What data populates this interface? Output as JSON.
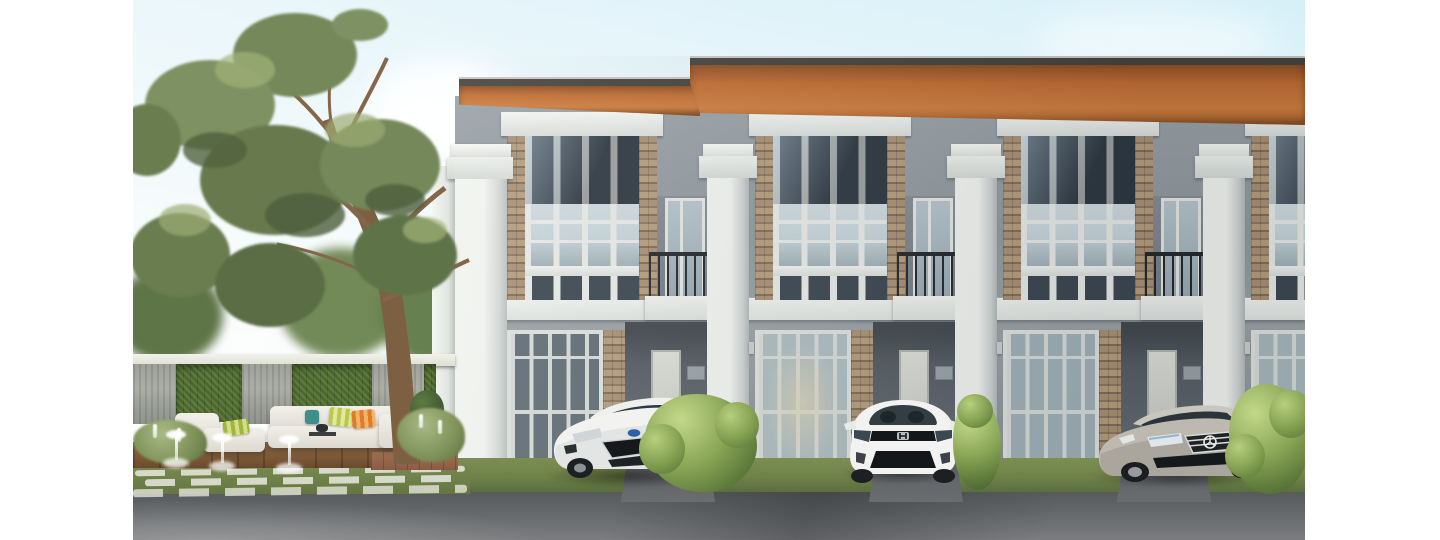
{
  "scene": {
    "description": "3D architectural rendering of a row of modern two-storey townhomes with orange timber roof eaves, parked cars in carports, and a landscaped garden courtyard with a large tree, vertical-garden boundary wall, outdoor sofa and lawn fountains",
    "palette": {
      "sky_top": "#a4cbdf",
      "sky_horizon": "#f1f4f1",
      "roof_soffit": "#bf6a2e",
      "roof_fascia": "#43403a",
      "wall_upper": "#8f979c",
      "wall_lower": "#888f94",
      "trim_white": "#e9ebe7",
      "glass_dark": "#3e4a55",
      "glass_light": "#c5d3d8",
      "stone": "#a18a6d",
      "carport_shadow": "#5c636a",
      "grass": "#6f8248",
      "hedge": "#4d6831",
      "deck_wood": "#7c5836",
      "road": "#636669",
      "car_white": "#f2f3f1",
      "car_silver": "#b6b2aa",
      "railing_black": "#23272b"
    }
  },
  "objects": {
    "tree": {
      "label": "large garden tree"
    },
    "garden_wall": {
      "label": "boundary wall with stone pillars and vertical garden panels",
      "pillar_count": 3,
      "hedge_panel_count": 2
    },
    "sofa": {
      "label": "white outdoor lounge sofa with colourful cushions"
    },
    "coffee_table": {
      "label": "outdoor coffee table"
    },
    "fountains": {
      "label": "lawn fountain jets",
      "count": 3
    },
    "townhouse_row": {
      "label": "modern two-storey townhome row",
      "visible_units": 4
    },
    "cars": [
      {
        "label": "white Ford hatchback parked in first carport"
      },
      {
        "label": "white Honda hatchback parked in second carport"
      },
      {
        "label": "silver Mercedes sedan parked in third carport"
      }
    ],
    "bushes": {
      "label": "trimmed green shrubs between carports",
      "count": 3
    }
  },
  "building": {
    "units": [
      {
        "pillar_x": 347,
        "door_glass": "#5f6b73",
        "door_glow": false,
        "back_door": true
      },
      {
        "pillar_x": 595,
        "door_glass": "#adbcc0",
        "door_glow": true,
        "back_door": true
      },
      {
        "pillar_x": 843,
        "door_glass": "#9fb0b6",
        "door_glow": false,
        "back_door": true
      },
      {
        "pillar_x": 1091,
        "door_glass": "#a7b6bb",
        "door_glow": false,
        "back_door": false
      }
    ]
  }
}
